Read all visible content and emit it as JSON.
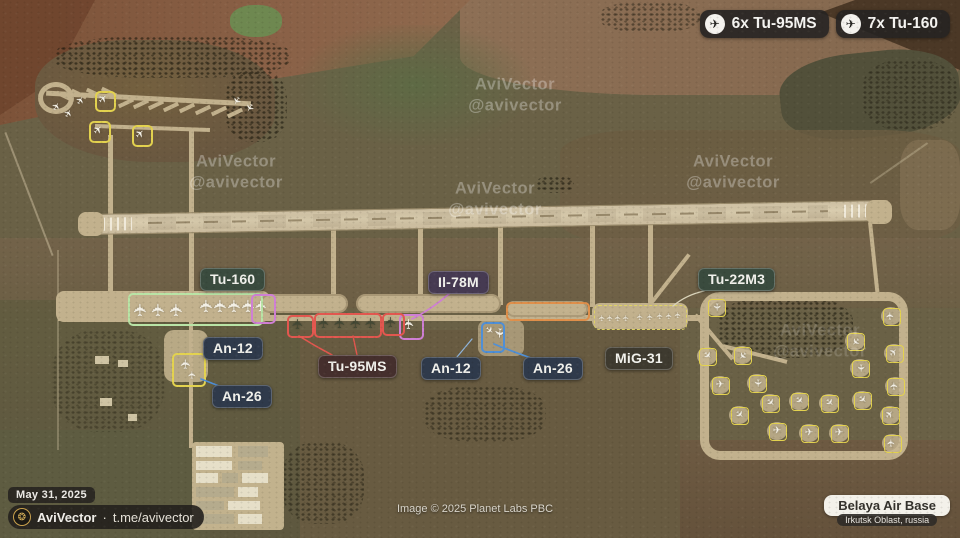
{
  "badges": [
    {
      "icon": "plane-icon",
      "label": "6x Tu-95MS"
    },
    {
      "icon": "plane-icon",
      "label": "7x Tu-160"
    }
  ],
  "annotations": {
    "tu160": {
      "label": "Tu-160",
      "bg": "#3a4b3e"
    },
    "il78m": {
      "label": "Il-78M",
      "bg": "#463a52"
    },
    "tu22m3": {
      "label": "Tu-22M3",
      "bg": "#3a4b3e"
    },
    "an12_left": {
      "label": "An-12",
      "bg": "#2f3a4b"
    },
    "an26_left": {
      "label": "An-26",
      "bg": "#2f3a4b"
    },
    "tu95ms": {
      "label": "Tu-95MS",
      "bg": "#452f2d"
    },
    "an12_center": {
      "label": "An-12",
      "bg": "#2f3a4b"
    },
    "an26_center": {
      "label": "An-26",
      "bg": "#2f3a4b"
    },
    "mig31": {
      "label": "MiG-31",
      "bg": "#3e3a2f"
    }
  },
  "watermark": {
    "line1": "AviVector",
    "line2": "@avivector"
  },
  "footer": {
    "date": "May 31, 2025",
    "brand": "AviVector",
    "separator": "·",
    "handle": "t.me/avivector",
    "image_credit": "Image © 2025 Planet Labs PBC",
    "base_name": "Belaya Air Base",
    "base_location": "Irkutsk Oblast, russia"
  },
  "highlight_colors": {
    "yellow": "#e3d24f",
    "green": "#b9e4a6",
    "magenta": "#cf7fd4",
    "red": "#e2574f",
    "blue": "#4f8fd6",
    "orange": "#df8f4a",
    "mig_dash": "#ded264",
    "neutral": "#d9d3ba",
    "lightblue": "#8fb4dc"
  }
}
